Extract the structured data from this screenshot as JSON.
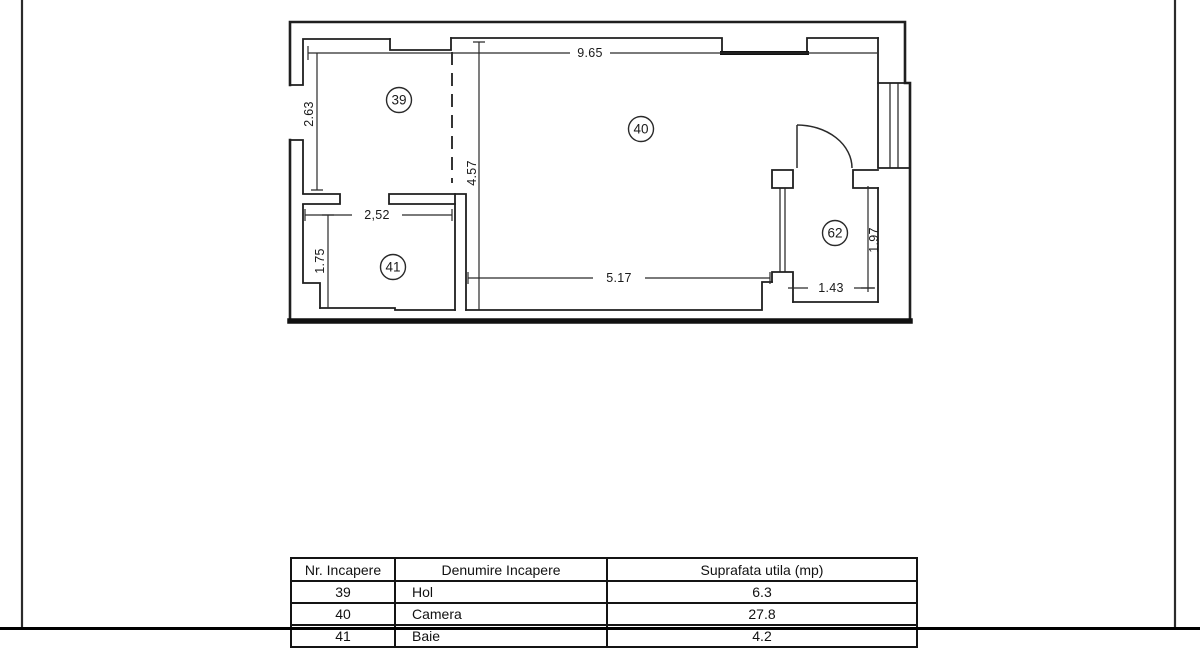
{
  "plan": {
    "rooms": {
      "r39": "39",
      "r40": "40",
      "r41": "41",
      "r62": "62"
    },
    "dims": {
      "top_width": "9.65",
      "left_height": "2.63",
      "interior_height": "4.57",
      "room41_width": "2,52",
      "room41_height": "1.75",
      "room40_width": "5.17",
      "room62_width": "1.43",
      "room62_height": "1.97"
    },
    "line_color": "#1f1f1f"
  },
  "table": {
    "headers": [
      "Nr. Incapere",
      "Denumire Incapere",
      "Suprafata utila (mp)"
    ],
    "rows": [
      {
        "nr": "39",
        "name": "Hol",
        "area": "6.3"
      },
      {
        "nr": "40",
        "name": "Camera",
        "area": "27.8"
      },
      {
        "nr": "41",
        "name": "Baie",
        "area": "4.2"
      }
    ]
  }
}
